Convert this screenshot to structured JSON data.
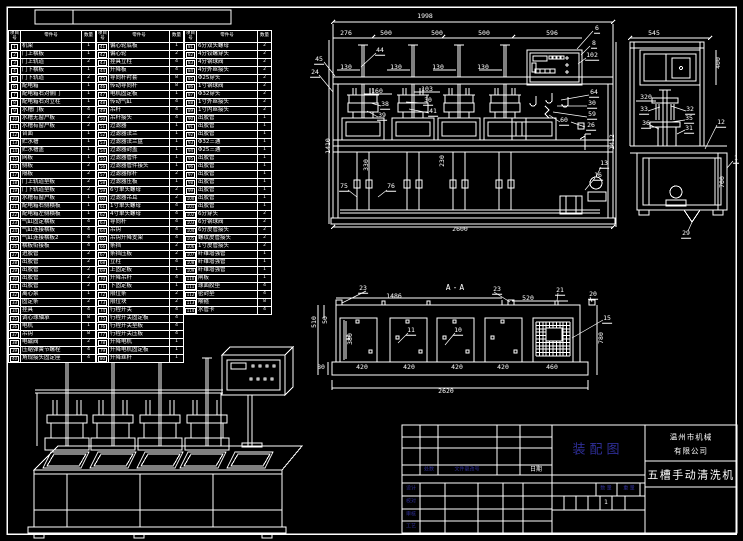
{
  "sheet": {
    "background": "#000000",
    "line_color": "#ffffff",
    "accent_color": "#2e2e96"
  },
  "parts_table": {
    "headers": {
      "item": "项目号",
      "part": "零件号",
      "qty": "数量"
    },
    "groups": [
      {
        "rows": [
          [
            "1",
            "机架",
            "1"
          ],
          [
            "2",
            "门上横板",
            "1"
          ],
          [
            "3",
            "门上轨道",
            "2"
          ],
          [
            "4",
            "门下横板",
            "1"
          ],
          [
            "5",
            "门下轨道",
            "2"
          ],
          [
            "6",
            "配电箱",
            "1"
          ],
          [
            "7",
            "配电箱右对侧门",
            "1"
          ],
          [
            "8",
            "配电箱右对立柱",
            "1"
          ],
          [
            "9",
            "水槽门板",
            "4"
          ],
          [
            "10",
            "水槽无窗户板",
            "2"
          ],
          [
            "11",
            "水槽有窗户板",
            "2"
          ],
          [
            "12",
            "台面",
            "1"
          ],
          [
            "13",
            "贮水槽",
            "1"
          ],
          [
            "14",
            "贮水槽盖",
            "1"
          ],
          [
            "15",
            "网板",
            "1"
          ],
          [
            "16",
            "侧板",
            "2"
          ],
          [
            "17",
            "隔板",
            "2"
          ],
          [
            "18",
            "门上轨道垫板",
            "2"
          ],
          [
            "19",
            "门下轨道垫板",
            "2"
          ],
          [
            "20",
            "水槽有窗户板",
            "1"
          ],
          [
            "21",
            "配电箱右侧横板",
            "1"
          ],
          [
            "22",
            "配电箱左侧横板",
            "1"
          ],
          [
            "23",
            "气缸固定横板",
            "4"
          ],
          [
            "24",
            "气缸连接横板",
            "4"
          ],
          [
            "25",
            "气缸连接横板2",
            "4"
          ],
          [
            "26",
            "横板衔接板",
            "4"
          ],
          [
            "27",
            "进胶管",
            "2"
          ],
          [
            "28",
            "出胶管",
            "2"
          ],
          [
            "29",
            "出胶管",
            "2"
          ],
          [
            "30",
            "出胶管",
            "2"
          ],
          [
            "31",
            "出胶管",
            "2"
          ],
          [
            "32",
            "离心泵",
            "1"
          ],
          [
            "33",
            "固定条",
            "2"
          ],
          [
            "34",
            "挂具",
            "4"
          ],
          [
            "35",
            "调心球轴承",
            "8"
          ],
          [
            "36",
            "电机",
            "1"
          ],
          [
            "37",
            "吊钩",
            "8"
          ],
          [
            "38",
            "电磁阀",
            "2"
          ],
          [
            "39",
            "压缩弹簧节螺栓",
            "4"
          ],
          [
            "40",
            "角规接头固定座",
            "4"
          ]
        ]
      },
      {
        "rows": [
          [
            "41",
            "偏心轮底板",
            "1"
          ],
          [
            "42",
            "偏心轮",
            "2"
          ],
          [
            "43",
            "挂具立柱",
            "4"
          ],
          [
            "44",
            "升降板",
            "4"
          ],
          [
            "45",
            "导向杆衬套",
            "8"
          ],
          [
            "46",
            "传动导向杆",
            "8"
          ],
          [
            "47",
            "电机固定板",
            "1"
          ],
          [
            "48",
            "传动气缸",
            "4"
          ],
          [
            "49",
            "吊杆",
            "4"
          ],
          [
            "50",
            "吊杆接头",
            "4"
          ],
          [
            "51",
            "过滤器",
            "1"
          ],
          [
            "52",
            "过滤器法兰",
            "1"
          ],
          [
            "53",
            "过滤器法兰盘",
            "1"
          ],
          [
            "54",
            "过滤器封盖",
            "1"
          ],
          [
            "55",
            "过滤器管件",
            "1"
          ],
          [
            "56",
            "过滤器管件接头",
            "1"
          ],
          [
            "57",
            "过滤器撑杆",
            "2"
          ],
          [
            "58",
            "过滤器压板",
            "1"
          ],
          [
            "59",
            "6寸单头螺母",
            "2"
          ],
          [
            "60",
            "过滤器吊耳",
            "2"
          ],
          [
            "61",
            "1寸单头螺母",
            "4"
          ],
          [
            "62",
            "4寸单头螺母",
            "4"
          ],
          [
            "63",
            "导向杆",
            "4"
          ],
          [
            "64",
            "吊钩",
            "4"
          ],
          [
            "65",
            "吊钩升降支架",
            "4"
          ],
          [
            "66",
            "条挡",
            "2"
          ],
          [
            "67",
            "条挡压板",
            "2"
          ],
          [
            "68",
            "立柱",
            "4"
          ],
          [
            "69",
            "上固定板",
            "1"
          ],
          [
            "70",
            "升降吊杆",
            "4"
          ],
          [
            "71",
            "下固定板",
            "1"
          ],
          [
            "72",
            "限位条",
            "2"
          ],
          [
            "73",
            "限位块",
            "2"
          ],
          [
            "74",
            "行程开关",
            "4"
          ],
          [
            "75",
            "行程开关固定板",
            "4"
          ],
          [
            "76",
            "行程开关垫板",
            "4"
          ],
          [
            "77",
            "行程开关压板",
            "4"
          ],
          [
            "78",
            "升降电机",
            "1"
          ],
          [
            "79",
            "升降电机固定板",
            "1"
          ],
          [
            "80",
            "升降丝杆",
            "1"
          ]
        ]
      },
      {
        "rows": [
          [
            "81",
            "6分双头螺母",
            "2"
          ],
          [
            "82",
            "4分铰螺穿头",
            "2"
          ],
          [
            "83",
            "4分钢球阀",
            "2"
          ],
          [
            "84",
            "4分外丝接头",
            "2"
          ],
          [
            "85",
            "Φ25穿头",
            "2"
          ],
          [
            "86",
            "1寸钢球阀",
            "2"
          ],
          [
            "87",
            "Φ32穿头",
            "2"
          ],
          [
            "88",
            "1寸外丝接头",
            "2"
          ],
          [
            "89",
            "1寸内丝接头",
            "2"
          ],
          [
            "90",
            "出胶管",
            "1"
          ],
          [
            "91",
            "出胶管",
            "1"
          ],
          [
            "92",
            "出胶管",
            "1"
          ],
          [
            "93",
            "Φ32三通",
            "1"
          ],
          [
            "94",
            "Φ25三通",
            "1"
          ],
          [
            "95",
            "出胶管",
            "1"
          ],
          [
            "96",
            "出胶管",
            "1"
          ],
          [
            "97",
            "出胶管",
            "1"
          ],
          [
            "98",
            "出胶管",
            "1"
          ],
          [
            "99",
            "出胶管",
            "1"
          ],
          [
            "100",
            "出胶管",
            "1"
          ],
          [
            "101",
            "出胶管",
            "1"
          ],
          [
            "102",
            "6分穿头",
            "2"
          ],
          [
            "103",
            "6分钢球阀",
            "2"
          ],
          [
            "104",
            "6分皮管接头",
            "2"
          ],
          [
            "105",
            "螺纹皮管接头",
            "2"
          ],
          [
            "106",
            "1寸皮管接头",
            "2"
          ],
          [
            "107",
            "纤维增强管",
            "1"
          ],
          [
            "108",
            "纤维增强管",
            "1"
          ],
          [
            "109",
            "纤维增强管",
            "1"
          ],
          [
            "110",
            "闸板",
            "1"
          ],
          [
            "111",
            "球面胶垫",
            "4"
          ],
          [
            "112",
            "密封垫",
            "4"
          ],
          [
            "113",
            "喉箍",
            "8"
          ],
          [
            "114",
            "水管卡",
            "4"
          ]
        ]
      }
    ]
  },
  "annotations": [
    {
      "t": "1998",
      "x": 425,
      "y": 16
    },
    {
      "t": "276",
      "x": 346,
      "y": 33
    },
    {
      "t": "500",
      "x": 386,
      "y": 33
    },
    {
      "t": "500",
      "x": 437,
      "y": 33
    },
    {
      "t": "500",
      "x": 484,
      "y": 33
    },
    {
      "t": "45",
      "x": 319,
      "y": 60,
      "cls": "co"
    },
    {
      "t": "24",
      "x": 315,
      "y": 73,
      "cls": "co"
    },
    {
      "t": "44",
      "x": 380,
      "y": 51,
      "cls": "co"
    },
    {
      "t": "130",
      "x": 346,
      "y": 67
    },
    {
      "t": "130",
      "x": 396,
      "y": 67
    },
    {
      "t": "130",
      "x": 438,
      "y": 67
    },
    {
      "t": "130",
      "x": 483,
      "y": 67
    },
    {
      "t": "160",
      "x": 377,
      "y": 91
    },
    {
      "t": "103",
      "x": 427,
      "y": 89
    },
    {
      "t": "30",
      "x": 428,
      "y": 101,
      "cls": "co"
    },
    {
      "t": "41",
      "x": 433,
      "y": 112,
      "cls": "co"
    },
    {
      "t": "38",
      "x": 385,
      "y": 105,
      "cls": "co"
    },
    {
      "t": "39",
      "x": 382,
      "y": 116,
      "cls": "co"
    },
    {
      "t": "1410",
      "x": 328,
      "y": 146,
      "r": -90
    },
    {
      "t": "330",
      "x": 366,
      "y": 165,
      "r": -90
    },
    {
      "t": "230",
      "x": 442,
      "y": 161,
      "r": -90
    },
    {
      "t": "75",
      "x": 344,
      "y": 187,
      "cls": "co"
    },
    {
      "t": "76",
      "x": 391,
      "y": 187,
      "cls": "co"
    },
    {
      "t": "2600",
      "x": 460,
      "y": 229
    },
    {
      "t": "13",
      "x": 604,
      "y": 164,
      "cls": "co"
    },
    {
      "t": "16",
      "x": 598,
      "y": 176,
      "cls": "co"
    },
    {
      "t": "596",
      "x": 552,
      "y": 33
    },
    {
      "t": "6",
      "x": 597,
      "y": 29,
      "cls": "co"
    },
    {
      "t": "8",
      "x": 594,
      "y": 44,
      "cls": "co"
    },
    {
      "t": "102",
      "x": 592,
      "y": 56,
      "cls": "co"
    },
    {
      "t": "64",
      "x": 594,
      "y": 93,
      "cls": "co"
    },
    {
      "t": "30",
      "x": 592,
      "y": 104,
      "cls": "co"
    },
    {
      "t": "59",
      "x": 592,
      "y": 115,
      "cls": "co"
    },
    {
      "t": "26",
      "x": 591,
      "y": 126,
      "cls": "co"
    },
    {
      "t": "60",
      "x": 564,
      "y": 121,
      "cls": "co"
    },
    {
      "t": "545",
      "x": 654,
      "y": 33
    },
    {
      "t": "400",
      "x": 718,
      "y": 63,
      "r": -90
    },
    {
      "t": "320",
      "x": 646,
      "y": 97
    },
    {
      "t": "33",
      "x": 644,
      "y": 110,
      "cls": "co"
    },
    {
      "t": "32",
      "x": 690,
      "y": 110,
      "cls": "co"
    },
    {
      "t": "35",
      "x": 689,
      "y": 119,
      "cls": "co"
    },
    {
      "t": "36",
      "x": 646,
      "y": 124,
      "cls": "co"
    },
    {
      "t": "31",
      "x": 689,
      "y": 129,
      "cls": "co"
    },
    {
      "t": "12",
      "x": 721,
      "y": 123,
      "cls": "co"
    },
    {
      "t": "1",
      "x": 736,
      "y": 159,
      "cls": "co"
    },
    {
      "t": "1412",
      "x": 612,
      "y": 142,
      "r": -90
    },
    {
      "t": "700",
      "x": 722,
      "y": 182,
      "r": -90
    },
    {
      "t": "29",
      "x": 686,
      "y": 234,
      "cls": "co"
    },
    {
      "t": "A-A",
      "x": 456,
      "y": 288,
      "cls": "sec"
    },
    {
      "t": "23",
      "x": 363,
      "y": 289,
      "cls": "co"
    },
    {
      "t": "1486",
      "x": 394,
      "y": 296
    },
    {
      "t": "23",
      "x": 497,
      "y": 290,
      "cls": "co"
    },
    {
      "t": "520",
      "x": 528,
      "y": 298
    },
    {
      "t": "21",
      "x": 560,
      "y": 291,
      "cls": "co"
    },
    {
      "t": "20",
      "x": 593,
      "y": 295,
      "cls": "co"
    },
    {
      "t": "510",
      "x": 314,
      "y": 322,
      "r": -90
    },
    {
      "t": "50",
      "x": 325,
      "y": 320,
      "r": -90
    },
    {
      "t": "380",
      "x": 350,
      "y": 339,
      "r": -90
    },
    {
      "t": "80",
      "x": 321,
      "y": 367
    },
    {
      "t": "420",
      "x": 362,
      "y": 367
    },
    {
      "t": "420",
      "x": 409,
      "y": 367
    },
    {
      "t": "420",
      "x": 457,
      "y": 367
    },
    {
      "t": "420",
      "x": 503,
      "y": 367
    },
    {
      "t": "460",
      "x": 552,
      "y": 367
    },
    {
      "t": "2620",
      "x": 446,
      "y": 391
    },
    {
      "t": "780",
      "x": 601,
      "y": 338,
      "r": -90
    },
    {
      "t": "11",
      "x": 411,
      "y": 331,
      "cls": "co"
    },
    {
      "t": "10",
      "x": 458,
      "y": 331,
      "cls": "co"
    },
    {
      "t": "15",
      "x": 607,
      "y": 319,
      "cls": "co"
    }
  ],
  "title_block": {
    "drawing_type": "装配图",
    "company_line1": "温州市机械",
    "company_line2": "有限公司",
    "product_name": "五槽手动清洗机",
    "labels": {
      "changes": "处数",
      "change_doc": "文件更改号",
      "date": "日期",
      "qty": "数 量",
      "weight": "重 量"
    },
    "sheet_count": "1",
    "sign_rows": [
      "设计",
      "校对",
      "审核",
      "工艺"
    ]
  }
}
